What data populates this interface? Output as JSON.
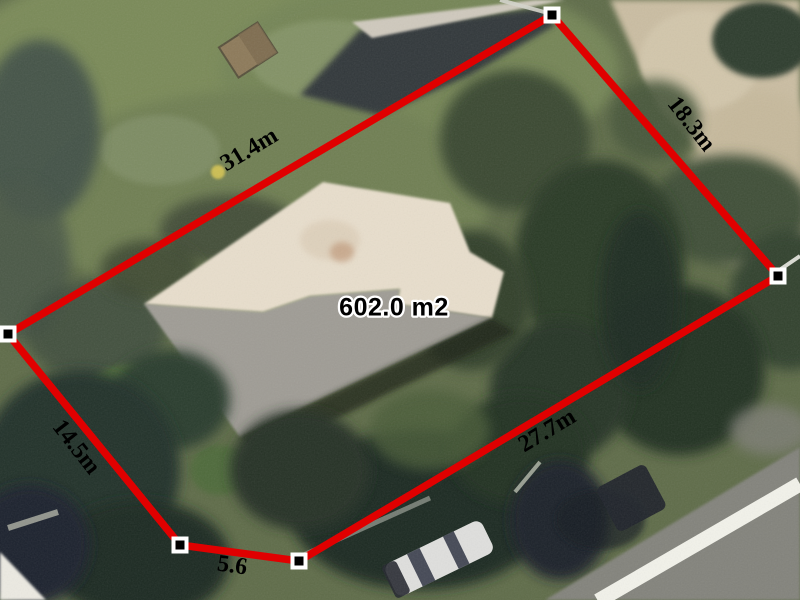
{
  "measurement_overlay": {
    "area_label": "602.0 m2",
    "edge_labels": {
      "top_left": "31.4m",
      "top_right": "18.3m",
      "bottom_right": "27.7m",
      "bottom_front": "5.6",
      "bottom_left": "14.5m"
    },
    "vertex_count": 5,
    "colors": {
      "boundary_line": "#e00000",
      "vertex_outer": "#ffffff",
      "vertex_inner": "#000000",
      "label_text": "#000000",
      "area_label_halo": "#ffffff"
    }
  }
}
